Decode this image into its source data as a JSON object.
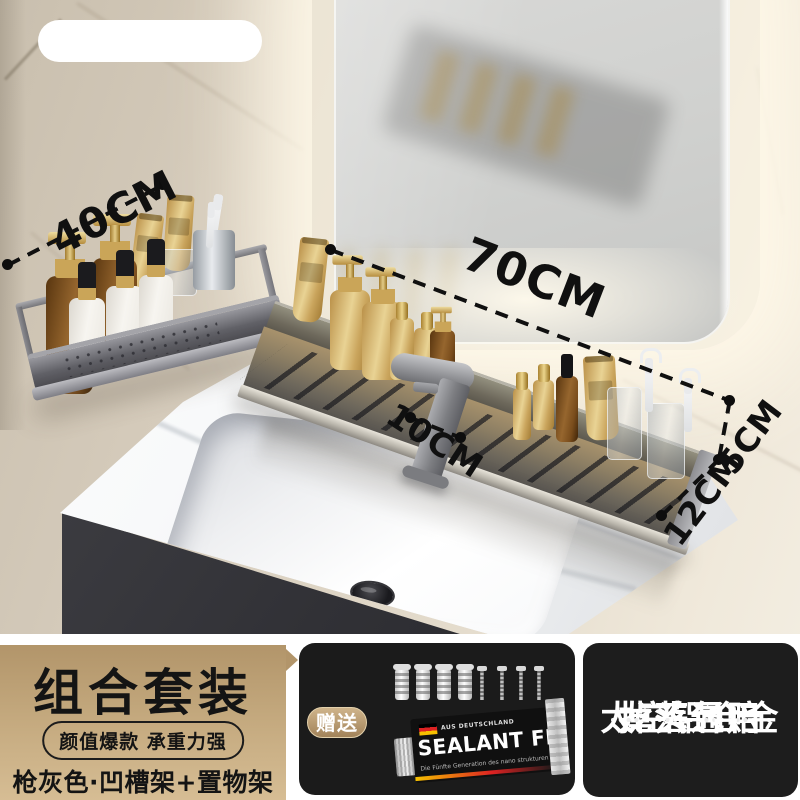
{
  "annotations": {
    "shelf_small_width": "40CM",
    "shelf_long_width": "70CM",
    "faucet_gap": "10CM",
    "shelf_depth": "12CM",
    "rail_height": "5CM"
  },
  "banner": {
    "left_panel": {
      "title": "组合套装",
      "badge": "颜值爆款 承重力强",
      "subtitle": "枪灰色·凹槽架+置物架"
    },
    "gift_panel": {
      "badge": "赠送",
      "tube": {
        "origin_label": "AUS DEUTSCHLAND",
        "brand": "SEALANT FIX",
        "subtext": "Die Fünfte Generation des nano strukturen in Deutschland"
      }
    },
    "right_panel": {
      "lines": [
        "龙头通用",
        "掉落包赔",
        "太空铝合金"
      ]
    }
  },
  "colors": {
    "gold_panel_top": "#b2956a",
    "gold_panel_bottom": "#d6bd94",
    "dark_panel": "#1b1b1b",
    "annotation_text": "#101010",
    "shelf_metal": "#6e685c",
    "wall": "#ddd4c4"
  }
}
